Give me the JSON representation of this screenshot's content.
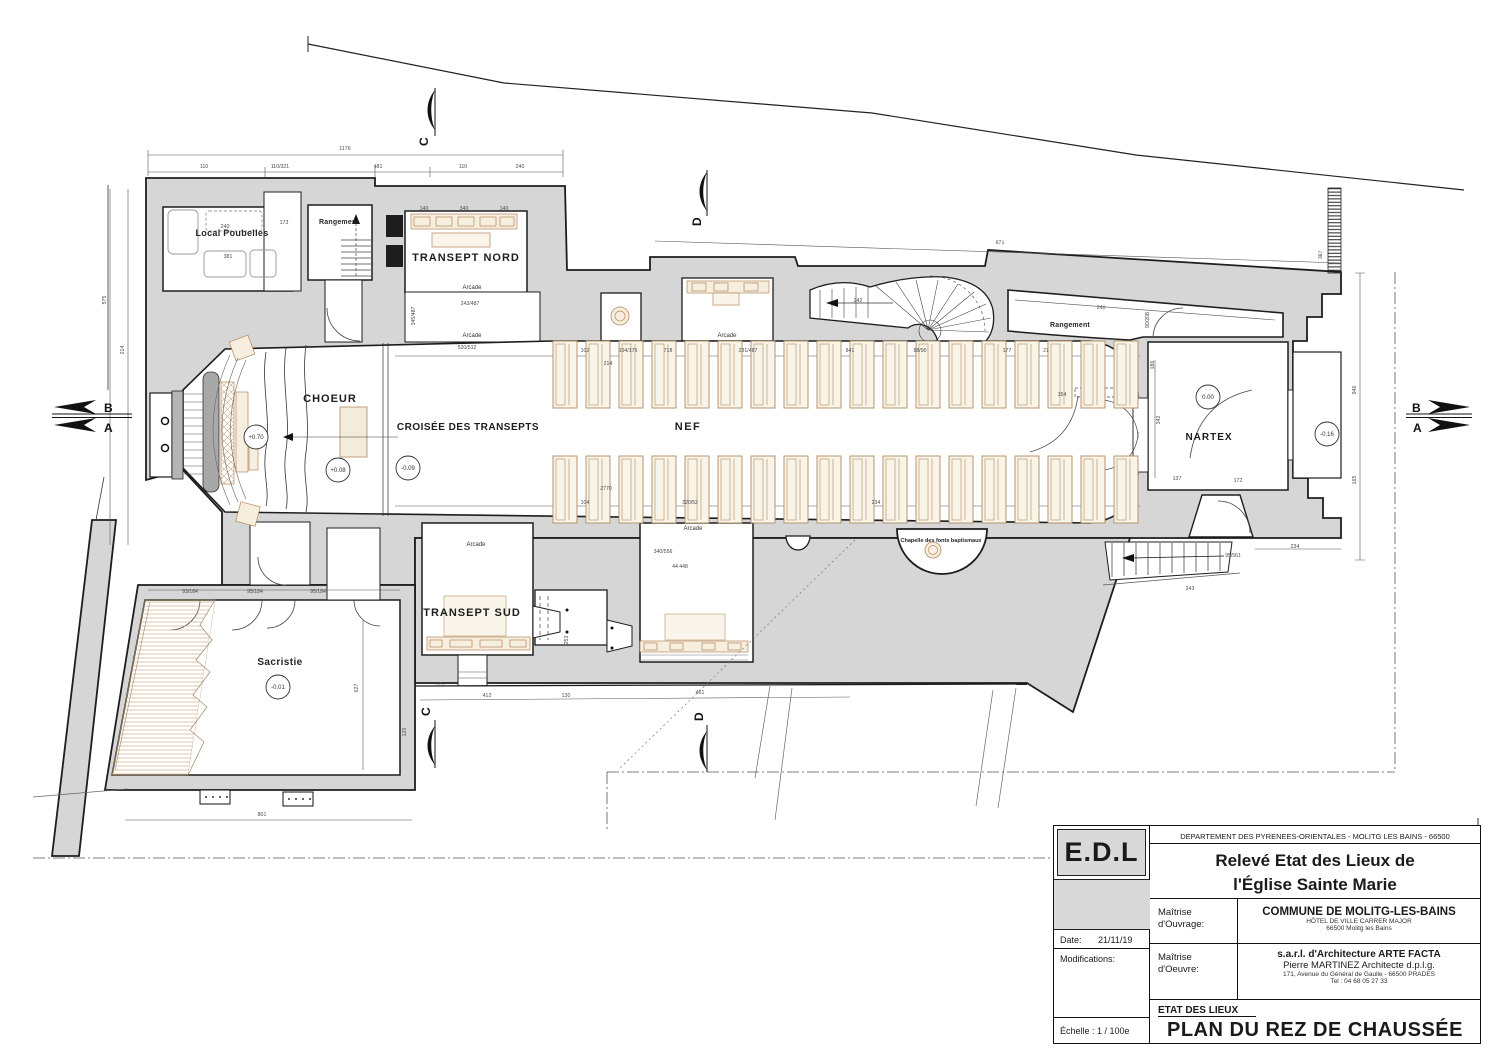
{
  "colors": {
    "poche": "#d6d6d6",
    "wall": "#1d1d1d",
    "furniture_fill": "#f6efdf",
    "furniture_stroke": "#b5885c",
    "hatch": "#cfae82",
    "dim_text": "#4a4a4a",
    "retable_slab": "#a8a8a8"
  },
  "title_block": {
    "logo": "E.D.L",
    "dept_line": "DEPARTEMENT DES PYRENEES-ORIENTALES - MOLITG LES BAINS - 66500",
    "title_line1": "Relevé Etat des Lieux de",
    "title_line2": "l'Église Sainte Marie",
    "date_label": "Date:",
    "date_value": "21/11/19",
    "modifications_label": "Modifications:",
    "scale_label": "Échelle : 1 / 100e",
    "ouvrage_label1": "Maîtrise",
    "ouvrage_label2": "d'Ouvrage:",
    "ouvrage_name": "COMMUNE DE MOLITG-LES-BAINS",
    "ouvrage_addr1": "HÔTEL DE VILLE   CARRER MAJOR",
    "ouvrage_addr2": "66500 Molitg les Bains",
    "oeuvre_label1": "Maîtrise",
    "oeuvre_label2": "d'Oeuvre:",
    "oeuvre_name": "s.a.r.l. d'Architecture  ARTE FACTA",
    "oeuvre_arch": "Pierre MARTINEZ Architecte d.p.l.g.",
    "oeuvre_addr": "171, Avenue du Général de Gaulle - 66500 PRADES",
    "oeuvre_tel": "Tel : 04 68 05 27 33",
    "phase": "ETAT DES LIEUX",
    "sheet_title": "PLAN DU REZ DE CHAUSSÉE"
  },
  "sections": {
    "b": "B",
    "a": "A",
    "c": "C",
    "d": "D"
  },
  "annotations": {
    "rooms": [
      {
        "id": "local-poubelles",
        "label": "Local Poubelles",
        "x": 232,
        "y": 236,
        "size": 9,
        "caps": false,
        "ls": 0.3
      },
      {
        "id": "rangement-ouest",
        "label": "Rangement",
        "x": 339,
        "y": 224,
        "size": 7,
        "caps": false,
        "ls": 0.2
      },
      {
        "id": "transept-nord",
        "label": "TRANSEPT NORD",
        "x": 466,
        "y": 261,
        "size": 11,
        "caps": true,
        "ls": 1
      },
      {
        "id": "choeur",
        "label": "CHOEUR",
        "x": 330,
        "y": 402,
        "size": 11,
        "caps": true,
        "ls": 1
      },
      {
        "id": "croisee",
        "label": "CROISÉE DES TRANSEPTS",
        "x": 468,
        "y": 430,
        "size": 10,
        "caps": true,
        "ls": 0.5
      },
      {
        "id": "nef",
        "label": "NEF",
        "x": 688,
        "y": 430,
        "size": 11,
        "caps": true,
        "ls": 1.5
      },
      {
        "id": "nartex",
        "label": "NARTEX",
        "x": 1209,
        "y": 440,
        "size": 10,
        "caps": true,
        "ls": 1
      },
      {
        "id": "rangement-nord",
        "label": "Rangement",
        "x": 1070,
        "y": 327,
        "size": 7,
        "caps": false,
        "ls": 0.2
      },
      {
        "id": "transept-sud",
        "label": "TRANSEPT SUD",
        "x": 472,
        "y": 616,
        "size": 11,
        "caps": true,
        "ls": 1
      },
      {
        "id": "sacristie",
        "label": "Sacristie",
        "x": 280,
        "y": 665,
        "size": 10,
        "caps": false,
        "ls": 0.4
      },
      {
        "id": "chapelle-fonts",
        "label": "Chapelle des fonts baptismaux",
        "x": 941,
        "y": 542,
        "size": 5.5,
        "caps": false,
        "ls": 0
      }
    ],
    "levels": [
      {
        "v": "+0.70",
        "x": 256,
        "y": 437
      },
      {
        "v": "+0.08",
        "x": 338,
        "y": 470
      },
      {
        "v": "-0.09",
        "x": 408,
        "y": 468
      },
      {
        "v": "0.00",
        "x": 1208,
        "y": 397
      },
      {
        "v": "-0.16",
        "x": 1327,
        "y": 434
      },
      {
        "v": "-0.01",
        "x": 278,
        "y": 687
      }
    ],
    "small_labels": [
      {
        "t": "Arcade",
        "x": 472,
        "y": 289
      },
      {
        "t": "Arcade",
        "x": 472,
        "y": 337
      },
      {
        "t": "Arcade",
        "x": 727,
        "y": 337
      },
      {
        "t": "Arcade",
        "x": 693,
        "y": 530
      },
      {
        "t": "Arcade",
        "x": 476,
        "y": 546
      }
    ],
    "dims": [
      [
        "1176",
        345,
        150,
        0
      ],
      [
        "110",
        204,
        168,
        0
      ],
      [
        "110/321",
        280,
        168,
        0
      ],
      [
        "481",
        378,
        168,
        0
      ],
      [
        "110",
        463,
        168,
        0
      ],
      [
        "240",
        520,
        168,
        0
      ],
      [
        "575",
        106,
        300,
        -90
      ],
      [
        "214",
        124,
        350,
        -90
      ],
      [
        "240",
        225,
        228,
        0
      ],
      [
        "381",
        228,
        258,
        0
      ],
      [
        "173",
        284,
        224,
        0
      ],
      [
        "871",
        1000,
        244,
        2
      ],
      [
        "387",
        1322,
        255,
        -85
      ],
      [
        "946",
        1356,
        390,
        -90
      ],
      [
        "165",
        1356,
        480,
        -90
      ],
      [
        "140",
        424,
        210,
        0
      ],
      [
        "340",
        464,
        210,
        0
      ],
      [
        "140",
        504,
        210,
        0
      ],
      [
        "345/487",
        415,
        316,
        -90
      ],
      [
        "243/487",
        470,
        305,
        0
      ],
      [
        "102",
        585,
        352,
        0
      ],
      [
        "104/175",
        628,
        352,
        0
      ],
      [
        "718",
        668,
        352,
        0
      ],
      [
        "231/487",
        748,
        352,
        0
      ],
      [
        "841",
        850,
        352,
        0
      ],
      [
        "88/90",
        920,
        352,
        0
      ],
      [
        "214",
        608,
        365,
        0
      ],
      [
        "520/512",
        467,
        349,
        0
      ],
      [
        "242",
        858,
        302,
        0
      ],
      [
        "177",
        1007,
        352,
        0
      ],
      [
        "21",
        1046,
        352,
        0
      ],
      [
        "240",
        1101,
        309,
        4
      ],
      [
        "90/208",
        1149,
        320,
        -90
      ],
      [
        "186",
        1154,
        365,
        -90
      ],
      [
        "154",
        1062,
        396,
        0
      ],
      [
        "2770",
        606,
        490,
        0
      ],
      [
        "104",
        585,
        504,
        0
      ],
      [
        "320/52",
        690,
        504,
        0
      ],
      [
        "234",
        876,
        504,
        0
      ],
      [
        "243",
        1190,
        590,
        0
      ],
      [
        "342",
        1160,
        420,
        -90
      ],
      [
        "137",
        1177,
        480,
        0
      ],
      [
        "172",
        1238,
        482,
        0
      ],
      [
        "234",
        1295,
        548,
        0
      ],
      [
        "95/561",
        1233,
        557,
        0
      ],
      [
        "340/556",
        663,
        553,
        0
      ],
      [
        "44 448",
        680,
        568,
        0
      ],
      [
        "253",
        568,
        640,
        -90
      ],
      [
        "93/184",
        190,
        593,
        0
      ],
      [
        "95/184",
        255,
        593,
        0
      ],
      [
        "95/184",
        318,
        593,
        0
      ],
      [
        "627",
        358,
        688,
        -90
      ],
      [
        "775",
        440,
        686,
        0
      ],
      [
        "412",
        487,
        697,
        0
      ],
      [
        "130",
        566,
        697,
        0
      ],
      [
        "461",
        700,
        694,
        0
      ],
      [
        "120",
        406,
        732,
        -90
      ],
      [
        "801",
        262,
        816,
        0
      ]
    ]
  },
  "furniture": {
    "nave_pews": {
      "w": 24,
      "pitch": 33,
      "rows": [
        {
          "x0": 553,
          "y": 341,
          "h": 67,
          "count": 18
        },
        {
          "x0": 553,
          "y": 456,
          "h": 67,
          "count": 18
        }
      ]
    }
  }
}
